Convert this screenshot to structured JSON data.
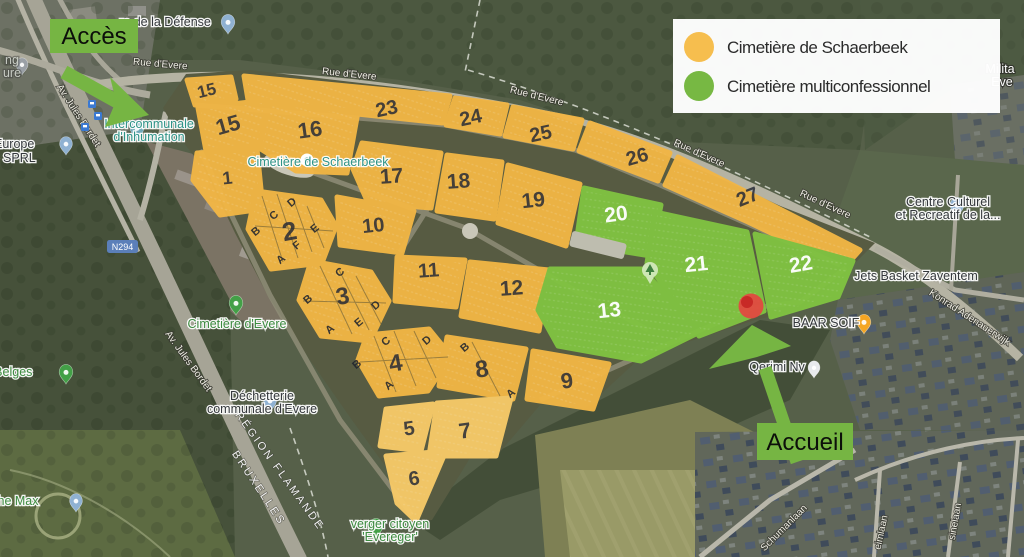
{
  "legend": {
    "items": [
      {
        "label": "Cimetière de Schaerbeek",
        "color": "#f6be4e"
      },
      {
        "label": "Cimetière multiconfessionnel",
        "color": "#77b843"
      }
    ]
  },
  "callouts": {
    "acces": "Accès",
    "accueil": "Accueil",
    "box_color": "#76b543"
  },
  "marker_color": "#e94040",
  "plots": {
    "orange_fill": "#f2b645",
    "orange_light_fill": "#f7ca68",
    "green_fill": "#80c341",
    "numbers": {
      "n15a": "15",
      "n15b": "15",
      "n16": "16",
      "n23": "23",
      "n24": "24",
      "n25": "25",
      "n26": "26",
      "n27": "27",
      "n1": "1",
      "n2": "2",
      "n17": "17",
      "n18": "18",
      "n19": "19",
      "n10": "10",
      "n11": "11",
      "n12": "12",
      "n3": "3",
      "n4": "4",
      "n8": "8",
      "n9": "9",
      "n5": "5",
      "n7": "7",
      "n6": "6",
      "n20": "20",
      "n21": "21",
      "n22": "22",
      "n13": "13"
    },
    "letters": [
      "D",
      "C",
      "B",
      "E",
      "F",
      "A",
      "C",
      "B",
      "A",
      "D",
      "E",
      "C",
      "D",
      "B",
      "A",
      "B",
      "A"
    ]
  },
  "streets": {
    "rue_devere": "Rue d'Evere",
    "av_jules_bordet": "Av. Jules Bordet",
    "n294": "N294",
    "konrad": "Konrad Adenauerwijk",
    "schumanlaan": "Schumanlaan",
    "eimlaan": "eimlaan",
    "sinelaan": "sinelaan",
    "region_flamande": "RÉGION FLAMANDE",
    "bruxelles": "BRUXELLES"
  },
  "pois": {
    "defense": "re de la Défense",
    "parking_line1": "ng",
    "parking_line2": "ure",
    "volt_line1": "Volt Europe",
    "volt_line2": "gium) SPRL",
    "intercommunale_line1": "Intercommunale",
    "intercommunale_line2": "d'Inhumation",
    "cimetiere_schaerbeek": "Cimetière de Schaerbeek",
    "cimetiere_evere": "Cimetière d'Evere",
    "dechetterie_line1": "Déchetterie",
    "dechetterie_line2": "communale d'Evere",
    "verger_line1": "verger citoyen",
    "verger_line2": "'Evereger'",
    "adolphe_max": "Adolphe Max",
    "aires_belges": "aires Belges",
    "baar_soif": "BAAR SOIF",
    "centre_line1": "Centre Culturel",
    "centre_line2": "et Recreatif de la...",
    "jets_basket": "Jets Basket Zaventem",
    "qerimi": "Qerimi Nv",
    "military_line1": "Milita",
    "military_line2": "Eve"
  }
}
